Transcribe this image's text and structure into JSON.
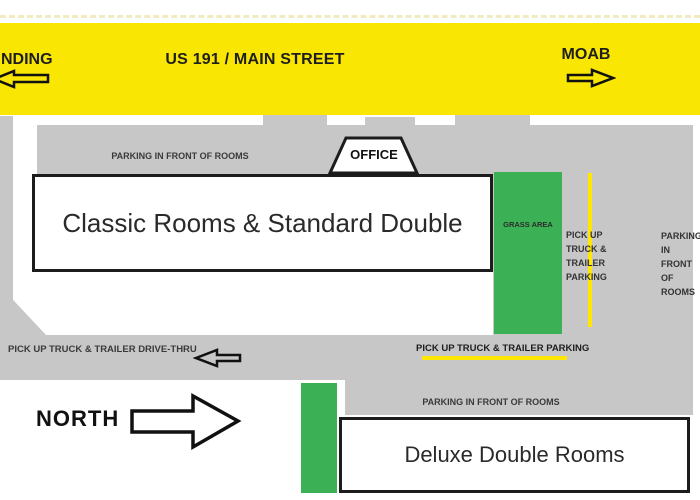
{
  "road": {
    "name_label": "US 191 / MAIN STREET",
    "west_label": "NDING",
    "east_label": "MOAB"
  },
  "office": {
    "label": "OFFICE"
  },
  "buildings": {
    "classic": {
      "label": "Classic Rooms & Standard Double"
    },
    "deluxe": {
      "label": "Deluxe Double Rooms"
    }
  },
  "areas": {
    "grass_label": "GRASS AREA"
  },
  "labels": {
    "parking_front_top": "PARKING IN FRONT OF ROOMS",
    "pickup_parking_east_lines": [
      "PICK UP",
      "TRUCK &",
      "TRAILER",
      "PARKING"
    ],
    "parking_front_east_lines": [
      "PARKING",
      "IN FRONT",
      "OF",
      "ROOMS"
    ],
    "drive_thru": "PICK UP TRUCK & TRAILER DRIVE-THRU",
    "pickup_parking_mid": "PICK UP TRUCK & TRAILER PARKING",
    "parking_front_bottom": "PARKING IN FRONT OF ROOMS",
    "north": "NORTH"
  },
  "icons": {
    "west_arrow": "left-arrow-outline",
    "east_arrow": "right-arrow-outline",
    "drive_thru_arrow": "left-arrow-outline",
    "north_arrow": "right-arrow-outline"
  },
  "colors": {
    "road_yellow": "#F9E602",
    "marking_yellow": "#FFE603",
    "grass_green": "#3CB054",
    "asphalt_gray": "#C7C7C7",
    "building_white": "#FFFFFF",
    "outline_black": "#1C1C1C",
    "label_ink": "#3A3A3A"
  }
}
